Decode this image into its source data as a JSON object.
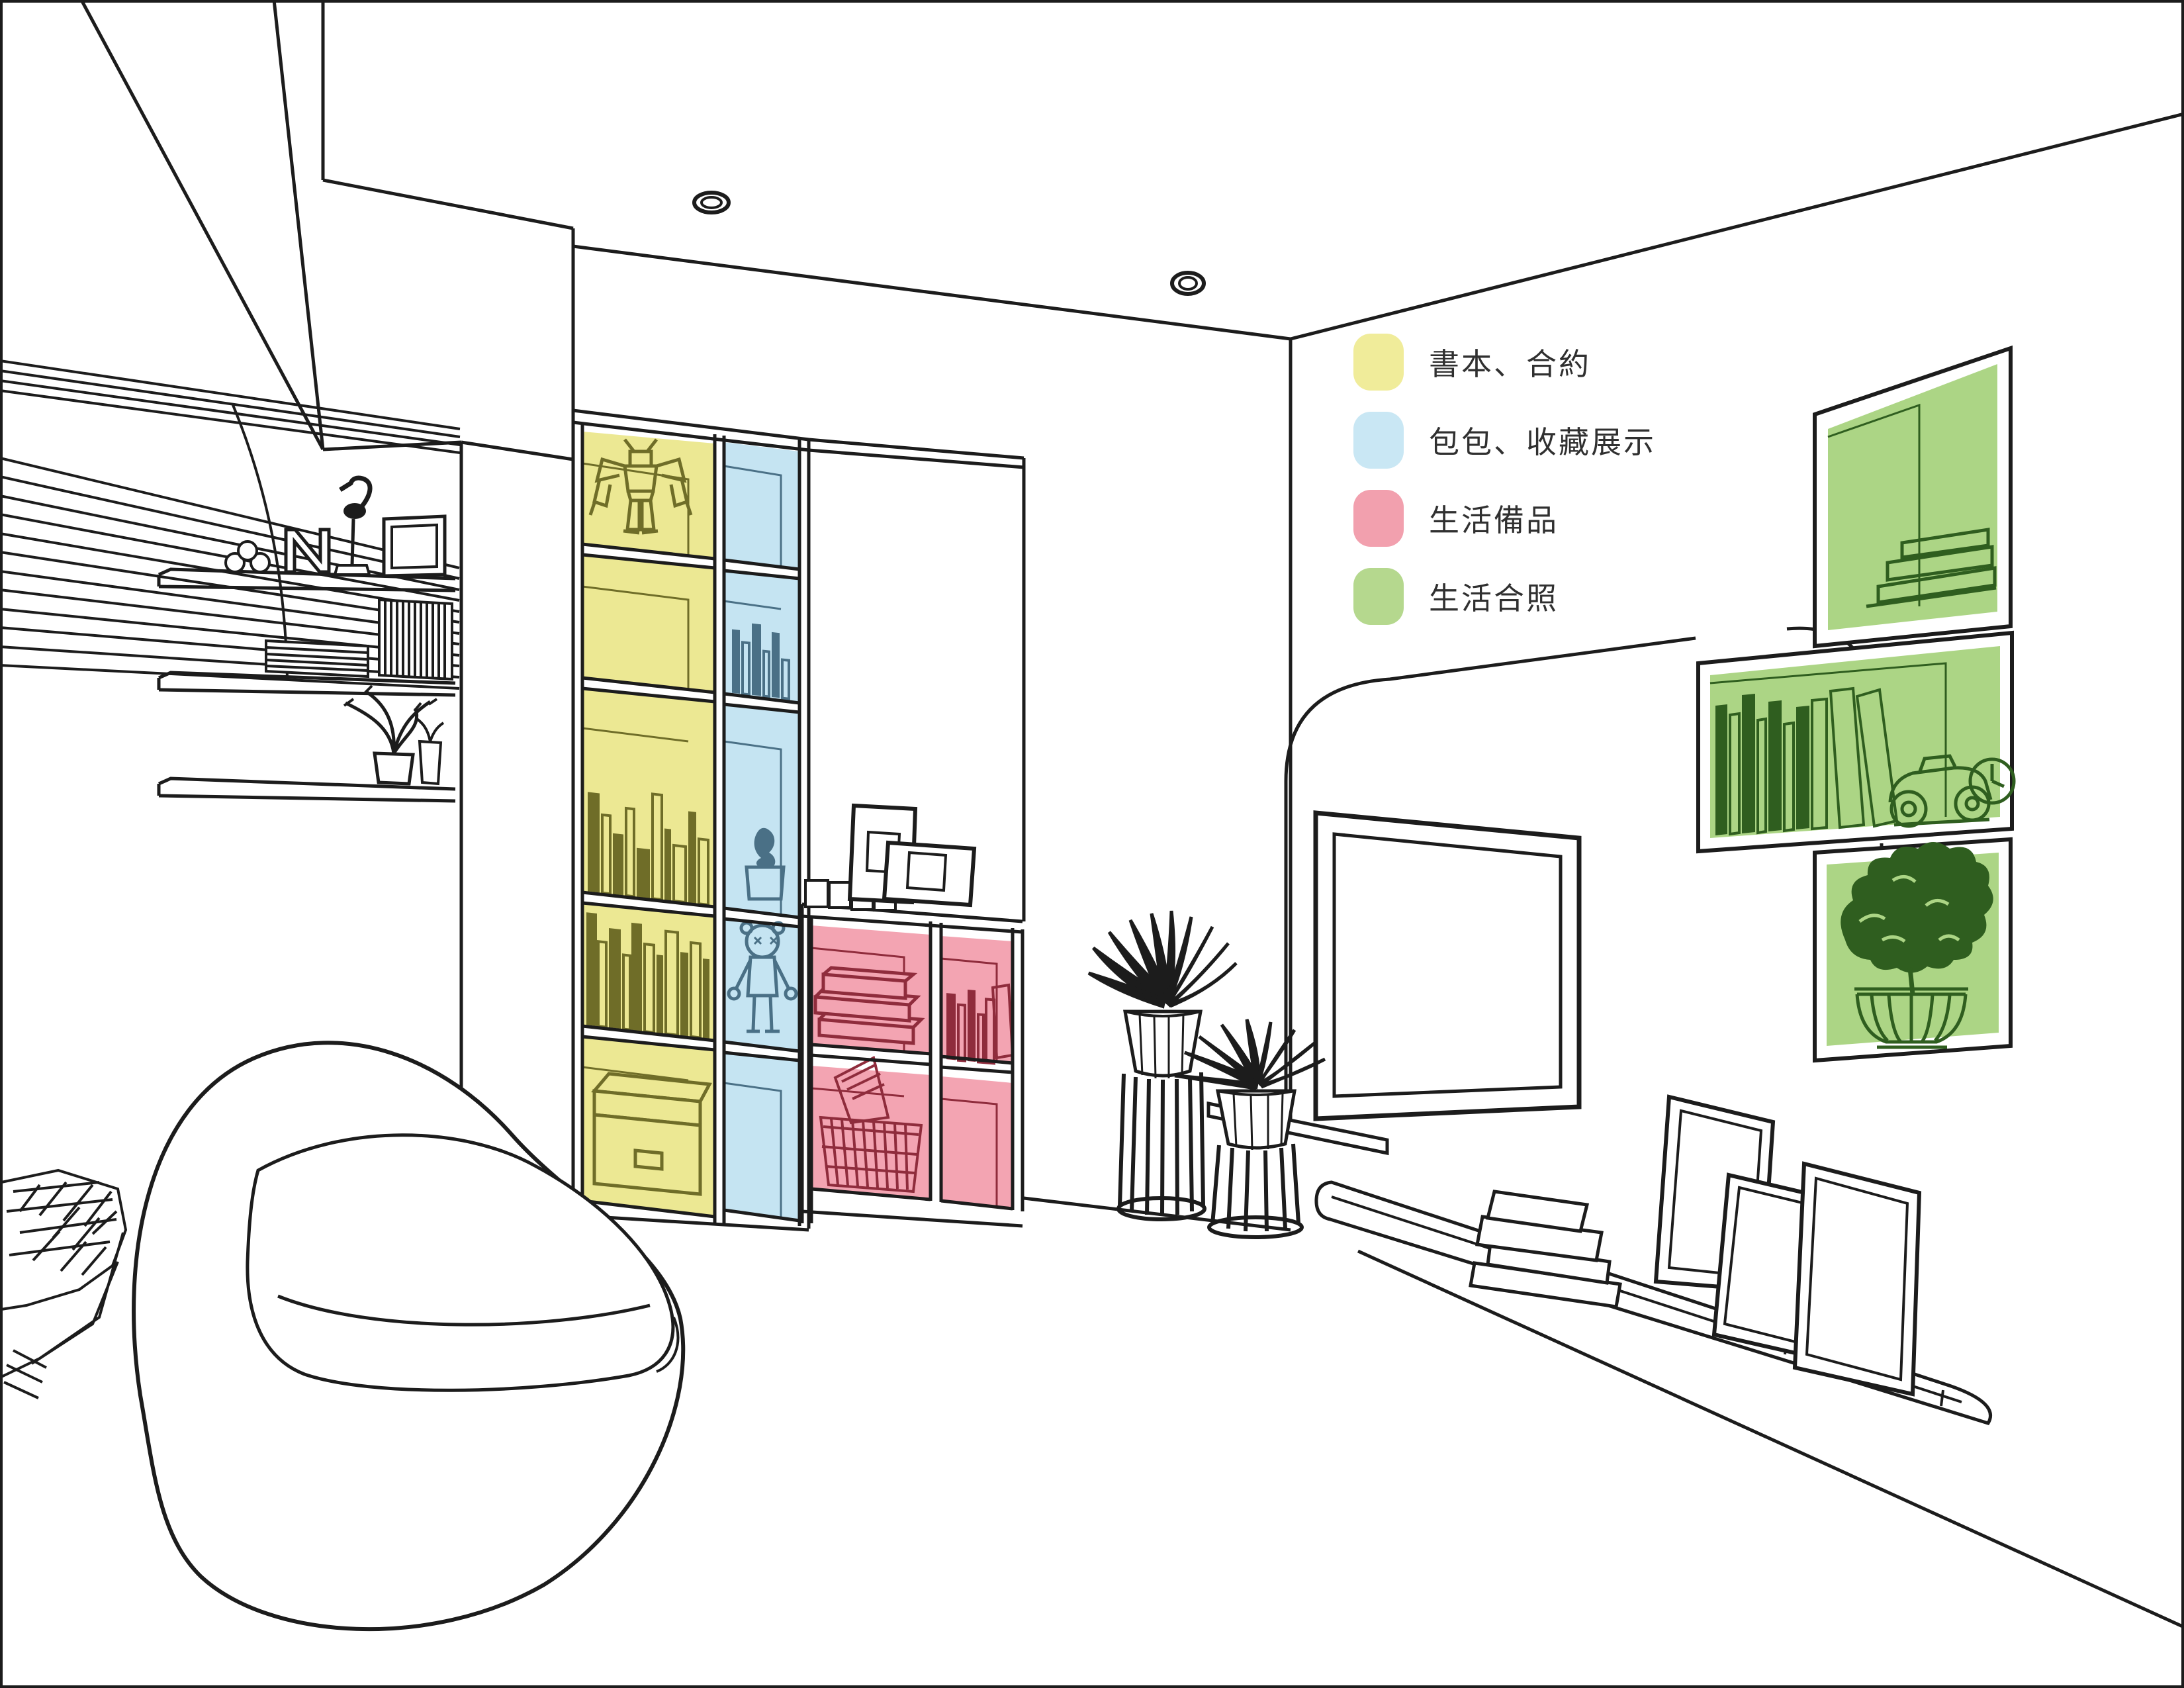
{
  "legend": {
    "items": [
      {
        "label": "書本、合約",
        "color": "#f0ec9a"
      },
      {
        "label": "包包、收藏展示",
        "color": "#c9e7f4"
      },
      {
        "label": "生活備品",
        "color": "#f2a0ae"
      },
      {
        "label": "生活合照",
        "color": "#b5d88e"
      }
    ]
  },
  "palette": {
    "zone_yellow": "#ece893",
    "zone_blue": "#c5e4f2",
    "zone_pink": "#f3a4b2",
    "zone_green": "#acd585",
    "line_black": "#1c1c1c",
    "line_yellow": "#6f6d28",
    "line_blue": "#4a7086",
    "line_pink": "#8f2c3c",
    "line_green": "#2f5e1f"
  },
  "scene": {
    "objects": [
      "slat-feature-wall",
      "wall-shelves",
      "letter-N-decor",
      "bird-figurine",
      "photo-frame",
      "tall-bookshelf-yellow-column",
      "tall-bookshelf-blue-column",
      "robot-figure",
      "kaws-figure",
      "pink-cube-storage",
      "wire-basket",
      "egg-pod-chair",
      "sketch-cushion",
      "wire-plant-stand-tall",
      "wire-plant-stand-short",
      "tv-feature-panel",
      "television",
      "floating-display-shelf",
      "leaning-picture-frames",
      "book-stack",
      "green-wall-box-top",
      "green-wall-box-middle",
      "green-wall-box-bottom",
      "toy-car",
      "clock",
      "bonsai-plant",
      "ceiling-downlights"
    ]
  }
}
